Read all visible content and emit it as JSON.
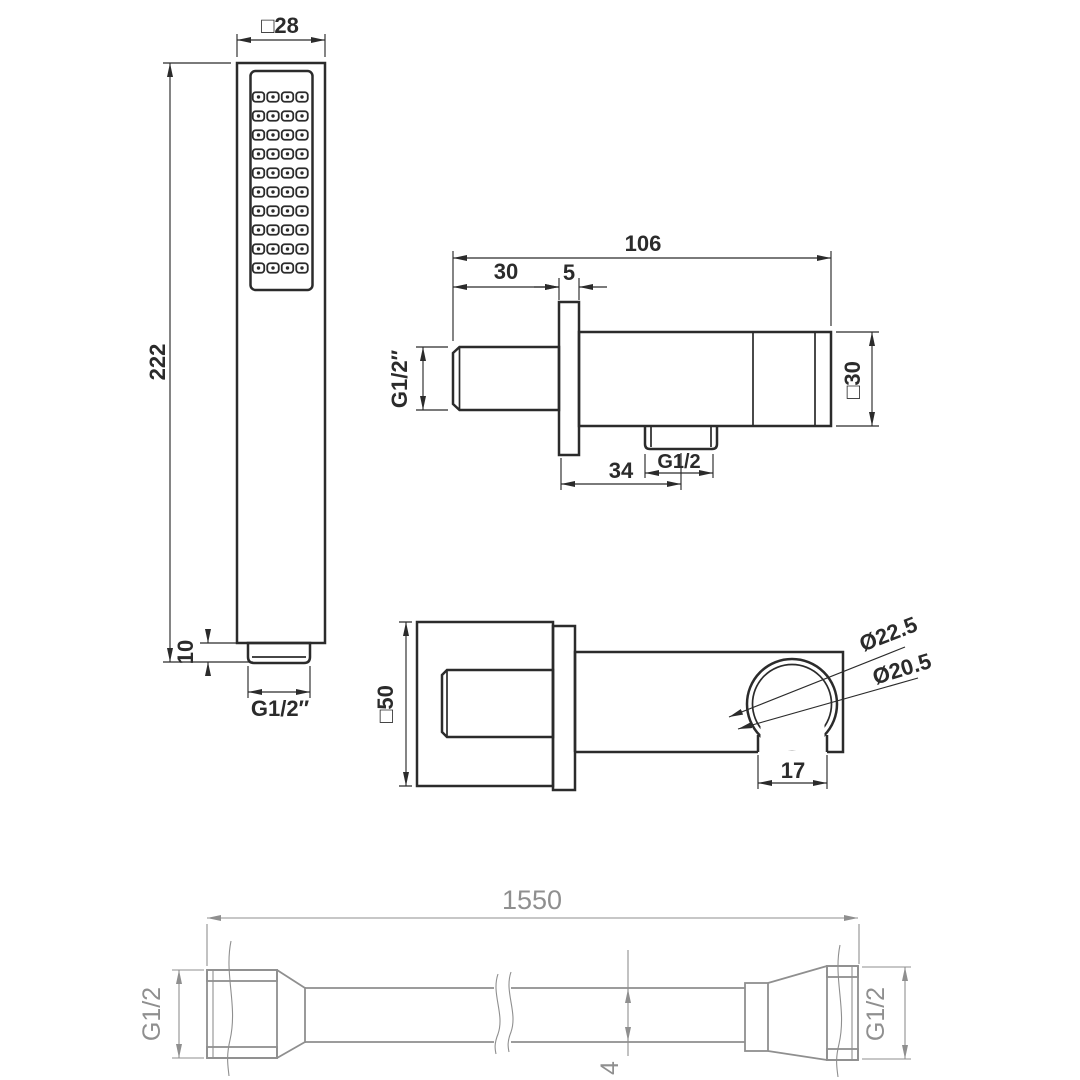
{
  "colors": {
    "ink": "#2b2b2b",
    "hose": "#8f8f8f",
    "background": "#ffffff"
  },
  "views": {
    "handset": {
      "label": "hand-shower-front-view",
      "nozzle_grid": {
        "rows": 10,
        "cols": 4
      },
      "dims": {
        "head_width": "□28",
        "total_length": "222",
        "tail_length": "10",
        "thread": "G1/2″"
      }
    },
    "outlet_side": {
      "label": "wall-outlet-side-view",
      "dims": {
        "total_depth": "106",
        "wall_offset": "30",
        "flange_thickness": "5",
        "inlet_thread": "G1/2″",
        "body_square": "□30",
        "outlet_offset": "34",
        "outlet_thread": "G1/2"
      }
    },
    "outlet_bottom": {
      "label": "wall-outlet-bottom-view",
      "dims": {
        "flange_square": "□50",
        "holder_outer_dia": "Ø22.5",
        "holder_inner_dia": "Ø20.5",
        "holder_opening": "17"
      }
    },
    "hose": {
      "label": "shower-hose-view",
      "dims": {
        "length": "1550",
        "left_thread": "G1/2",
        "right_thread": "G1/2",
        "dia_partial": "4"
      }
    }
  }
}
